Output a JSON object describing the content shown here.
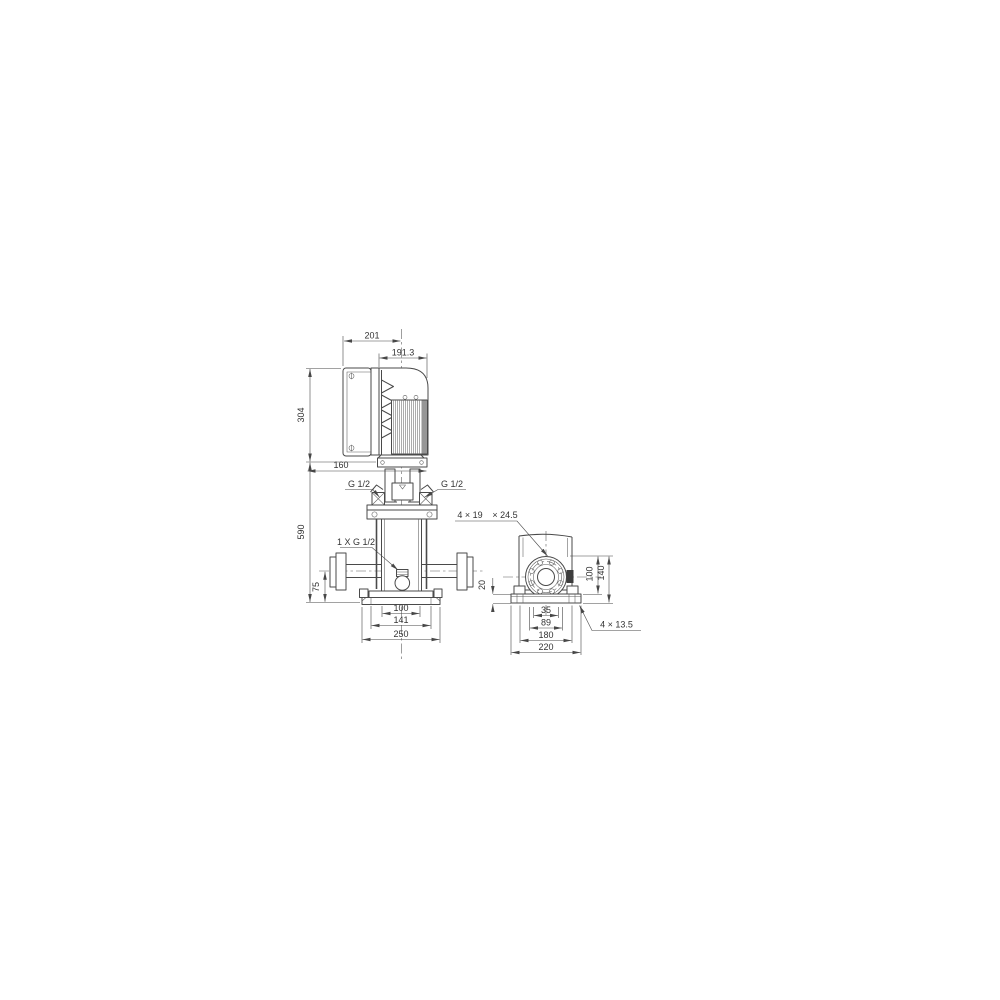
{
  "meta": {
    "background_color": "#ffffff",
    "line_color": "#4a4a4a",
    "drawing_type": "pump dimensional drawing, front view and side view"
  },
  "front": {
    "dim_width_overall": "201",
    "dim_width_motor": "191.3",
    "dim_height_motor": "304",
    "dim_clearance": "160",
    "dim_height_pump": "590",
    "dim_height_port": "75",
    "label_port_left": "G 1/2",
    "label_port_right": "G 1/2",
    "label_drain": "1 X G 1/2",
    "dim_base_100": "100",
    "dim_base_141": "141",
    "dim_base_250": "250"
  },
  "side": {
    "label_flange_holes_1": "4 × 19",
    "label_flange_holes_2": "× 24.5",
    "dim_plate_20": "20",
    "dim_height_100": "100",
    "dim_height_140": "140",
    "dim_holes_35": "35",
    "dim_holes_89": "89",
    "dim_base_180": "180",
    "dim_base_220": "220",
    "label_base_holes": "4 × 13.5"
  }
}
